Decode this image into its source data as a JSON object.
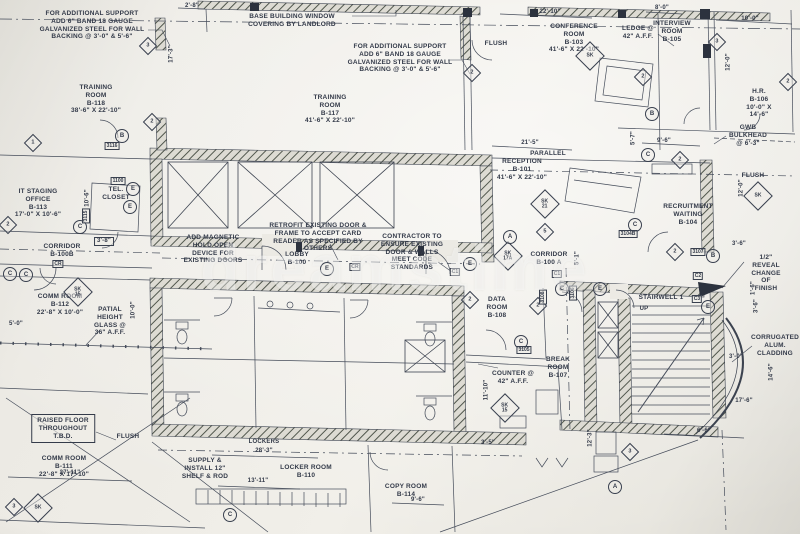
{
  "palette": {
    "paper": "#eceae4",
    "ink": "#3c4350",
    "wall_hatch": "#4f554b",
    "solid": "#2c323e"
  },
  "watermark": {
    "text": "dreamstime"
  },
  "plan": {
    "labels": [
      {
        "name": "note-additional-support-left",
        "cls": "note",
        "x": 92,
        "y": 10,
        "text": "FOR ADDITIONAL SUPPORT\nADD 6\" BAND 18 GAUGE\nGALVANIZED STEEL FOR WALL\nBACKING @ 3'-0\" & 5'-6\""
      },
      {
        "name": "note-base-building-window",
        "cls": "note",
        "x": 292,
        "y": 13,
        "text": "BASE BUILDING WINDOW\nCOVERING BY LANDLORD"
      },
      {
        "name": "note-additional-support-center",
        "cls": "note",
        "x": 400,
        "y": 43,
        "text": "FOR ADDITIONAL SUPPORT\nADD 6\" BAND 18 GAUGE\nGALVANIZED STEEL FOR WALL\nBACKING @ 3'-0\" & 5'-6\""
      },
      {
        "name": "label-flush-conference",
        "cls": "note",
        "x": 496,
        "y": 40,
        "text": "FLUSH"
      },
      {
        "name": "room-conference",
        "cls": "room",
        "x": 574,
        "y": 23,
        "text": "CONFERENCE\nROOM\nB-103\n41'-6\" X 22'-10\""
      },
      {
        "name": "note-ledge",
        "cls": "note",
        "x": 638,
        "y": 25,
        "text": "LEDGE @\n42\" A.F.F."
      },
      {
        "name": "dim-22-10",
        "cls": "dim",
        "x": 550,
        "y": 9,
        "text": "22'-10\""
      },
      {
        "name": "dim-8-0",
        "cls": "dim",
        "x": 662,
        "y": 5,
        "text": "8'-0\""
      },
      {
        "name": "room-interview",
        "cls": "room",
        "x": 672,
        "y": 20,
        "text": "INTERVIEW\nROOM\nB-105"
      },
      {
        "name": "dim-10-0-top",
        "cls": "dim",
        "x": 750,
        "y": 16,
        "text": "10'-0\""
      },
      {
        "name": "dim-12-0-right",
        "cls": "dimv",
        "x": 729,
        "y": 62,
        "text": "12'-0\""
      },
      {
        "name": "room-hr",
        "cls": "room",
        "x": 759,
        "y": 88,
        "text": "H.R.\nB-106\n10'-0\" X 14'-6\""
      },
      {
        "name": "note-gwb-bulkhead",
        "cls": "note",
        "x": 748,
        "y": 124,
        "text": "GWB\nBULKHEAD\n@ 6'-3\""
      },
      {
        "name": "dim-5-7",
        "cls": "dimv",
        "x": 634,
        "y": 138,
        "text": "5'-7\""
      },
      {
        "name": "dim-9-6-recruitment",
        "cls": "dim",
        "x": 664,
        "y": 138,
        "text": "9'-6\""
      },
      {
        "name": "room-training-center",
        "cls": "room",
        "x": 330,
        "y": 94,
        "text": "TRAINING\nROOM\nB-117\n41'-6\" X 22'-10\""
      },
      {
        "name": "room-training-left",
        "cls": "room",
        "x": 96,
        "y": 84,
        "text": "TRAINING\nROOM\nB-118\n38'-6\" X 22'-10\""
      },
      {
        "name": "dim-17-3",
        "cls": "dimv",
        "x": 172,
        "y": 54,
        "text": "17'-3\""
      },
      {
        "name": "dim-2-8",
        "cls": "dim",
        "x": 192,
        "y": 3,
        "text": "2'-8\""
      },
      {
        "name": "room-it-staging",
        "cls": "room",
        "x": 38,
        "y": 188,
        "text": "IT STAGING\nOFFICE\nB-113\n17'-0\" X 10'-6\""
      },
      {
        "name": "room-tel-closet",
        "cls": "room",
        "x": 116,
        "y": 186,
        "text": "TEL.\nCLOSET"
      },
      {
        "name": "dim-10-6",
        "cls": "dimv",
        "x": 88,
        "y": 198,
        "text": "10'-6\""
      },
      {
        "name": "dim-3-8",
        "cls": "dimbox",
        "x": 104,
        "y": 237,
        "text": "3'-8\""
      },
      {
        "name": "room-corridor-b100b",
        "cls": "room",
        "x": 62,
        "y": 243,
        "text": "CORRIDOR\nB-100B"
      },
      {
        "name": "room-comm-112",
        "cls": "room",
        "x": 60,
        "y": 293,
        "text": "COMM ROOM\nB-112\n22'-8\" X 10'-0\""
      },
      {
        "name": "note-partial-glass",
        "cls": "note",
        "x": 110,
        "y": 306,
        "text": "PATIAL\nHEIGHT\nGLASS @\n36\" A.F.F."
      },
      {
        "name": "dim-5-0",
        "cls": "dim",
        "x": 16,
        "y": 321,
        "text": "5'-0\""
      },
      {
        "name": "dim-10-0-glass",
        "cls": "dimv",
        "x": 134,
        "y": 310,
        "text": "10'-0\""
      },
      {
        "name": "note-add-magnetic",
        "cls": "note",
        "x": 213,
        "y": 234,
        "text": "ADD MAGNETIC\nHOLD OPEN\nDEVICE FOR\nEXISTING DOORS"
      },
      {
        "name": "note-retrofit",
        "cls": "note",
        "x": 318,
        "y": 222,
        "text": "RETROFIT EXISTING DOOR &\nFRAME TO ACCEPT CARD\nREADER AS SPECIFIED BY\nOTHERS"
      },
      {
        "name": "room-lobby",
        "cls": "room",
        "x": 297,
        "y": 251,
        "text": "LOBBY\nB-100"
      },
      {
        "name": "note-contractor",
        "cls": "note",
        "x": 412,
        "y": 233,
        "text": "CONTRACTOR TO\nENSURE EXISTING\nDOOR & WALLS\nMEET CODE\nSTANDARDS"
      },
      {
        "name": "room-corridor-b100a",
        "cls": "room",
        "x": 549,
        "y": 251,
        "text": "CORRIDOR\nB-100 A"
      },
      {
        "name": "dim-5-1",
        "cls": "dimv",
        "x": 578,
        "y": 258,
        "text": "5'-1\""
      },
      {
        "name": "room-reception",
        "cls": "room",
        "x": 522,
        "y": 158,
        "text": "RECEPTION\nB-101\n41'-6\" X 22'-10\""
      },
      {
        "name": "note-parallel",
        "cls": "note",
        "x": 548,
        "y": 150,
        "text": "PARALLEL"
      },
      {
        "name": "dim-21-5",
        "cls": "dim",
        "x": 530,
        "y": 140,
        "text": "21'-5\""
      },
      {
        "name": "room-recruitment",
        "cls": "room",
        "x": 688,
        "y": 203,
        "text": "RECRUITMENT\nWAITING\nB-104"
      },
      {
        "name": "label-flush-right",
        "cls": "note",
        "x": 753,
        "y": 172,
        "text": "FLUSH"
      },
      {
        "name": "dim-12-0-recruitment",
        "cls": "dimv",
        "x": 742,
        "y": 188,
        "text": "12'-0\""
      },
      {
        "name": "dim-3-6-right",
        "cls": "dim",
        "x": 739,
        "y": 241,
        "text": "3'-6\""
      },
      {
        "name": "note-reveal",
        "cls": "note",
        "x": 766,
        "y": 254,
        "text": "1/2\" REVEAL\nCHANGE OF\nFINISH"
      },
      {
        "name": "room-stairwell",
        "cls": "room",
        "x": 661,
        "y": 294,
        "text": "STAIRWELL 1"
      },
      {
        "name": "label-up",
        "cls": "small",
        "x": 644,
        "y": 306,
        "text": "UP"
      },
      {
        "name": "note-cladding",
        "cls": "note",
        "x": 775,
        "y": 334,
        "text": "CORRUGATED\nALUM.\nCLADDING"
      },
      {
        "name": "dim-1-6",
        "cls": "dimv",
        "x": 754,
        "y": 288,
        "text": "1'-6\""
      },
      {
        "name": "dim-3-6-stair",
        "cls": "dimv",
        "x": 757,
        "y": 306,
        "text": "3'-6\""
      },
      {
        "name": "dim-3-0",
        "cls": "dim",
        "x": 736,
        "y": 354,
        "text": "3'-0\""
      },
      {
        "name": "dim-14-6",
        "cls": "dimv",
        "x": 772,
        "y": 372,
        "text": "14'-6\""
      },
      {
        "name": "dim-17-6",
        "cls": "dim",
        "x": 744,
        "y": 398,
        "text": "17'-6\""
      },
      {
        "name": "room-data",
        "cls": "room",
        "x": 497,
        "y": 296,
        "text": "DATA\nROOM\nB-108"
      },
      {
        "name": "room-break",
        "cls": "room",
        "x": 558,
        "y": 356,
        "text": "BREAK\nROOM\nB-107"
      },
      {
        "name": "note-counter",
        "cls": "note",
        "x": 513,
        "y": 370,
        "text": "COUNTER @\n42\" A.F.F."
      },
      {
        "name": "dim-11-10",
        "cls": "dimv",
        "x": 487,
        "y": 390,
        "text": "11'-10\""
      },
      {
        "name": "dim-3-5",
        "cls": "dim",
        "x": 488,
        "y": 440,
        "text": "3'-5\""
      },
      {
        "name": "note-raised-floor",
        "cls": "notebox",
        "x": 63,
        "y": 414,
        "text": "RAISED FLOOR\nTHROUGHOUT\nT.B.D."
      },
      {
        "name": "room-comm-111",
        "cls": "room",
        "x": 64,
        "y": 455,
        "text": "COMM ROOM\nB-111\n22'-8\" X 17'-10\""
      },
      {
        "name": "dim-27-11",
        "cls": "dim",
        "x": 70,
        "y": 470,
        "text": "27'-11\""
      },
      {
        "name": "label-flush-bottom",
        "cls": "note",
        "x": 128,
        "y": 433,
        "text": "FLUSH"
      },
      {
        "name": "label-lockers",
        "cls": "small",
        "x": 264,
        "y": 439,
        "text": "LOCKERS"
      },
      {
        "name": "dim-28-3",
        "cls": "dim",
        "x": 264,
        "y": 448,
        "text": "28'-3\""
      },
      {
        "name": "note-shelf-rod",
        "cls": "note",
        "x": 205,
        "y": 457,
        "text": "SUPPLY &\nINSTALL 12\"\nSHELF & ROD"
      },
      {
        "name": "room-locker",
        "cls": "room",
        "x": 306,
        "y": 464,
        "text": "LOCKER ROOM\nB-110"
      },
      {
        "name": "dim-13-11",
        "cls": "dim",
        "x": 258,
        "y": 478,
        "text": "13'-11\""
      },
      {
        "name": "room-copy",
        "cls": "room",
        "x": 406,
        "y": 483,
        "text": "COPY ROOM\nB-114"
      },
      {
        "name": "dim-9-6-copy",
        "cls": "dim",
        "x": 418,
        "y": 497,
        "text": "9'-6\""
      },
      {
        "name": "dim-6-6",
        "cls": "dim",
        "x": 704,
        "y": 428,
        "text": "6'-6\""
      },
      {
        "name": "dim-12-3",
        "cls": "dimv",
        "x": 591,
        "y": 438,
        "text": "12'-3\""
      }
    ],
    "diamond_markers": [
      {
        "x": 148,
        "y": 46,
        "text": "3",
        "big": false
      },
      {
        "x": 472,
        "y": 73,
        "text": "2",
        "big": false
      },
      {
        "x": 152,
        "y": 122,
        "text": "2",
        "big": false
      },
      {
        "x": 33,
        "y": 143,
        "text": "1",
        "big": false
      },
      {
        "x": 717,
        "y": 42,
        "text": "3",
        "big": false
      },
      {
        "x": 643,
        "y": 77,
        "text": "2",
        "big": false
      },
      {
        "x": 788,
        "y": 82,
        "text": "2",
        "big": false
      },
      {
        "x": 8,
        "y": 225,
        "text": "2",
        "big": false
      },
      {
        "x": 538,
        "y": 306,
        "text": "2",
        "big": false
      },
      {
        "x": 545,
        "y": 232,
        "text": "5",
        "big": false
      },
      {
        "x": 680,
        "y": 160,
        "text": "2",
        "big": false
      },
      {
        "x": 675,
        "y": 252,
        "text": "2",
        "big": false
      },
      {
        "x": 630,
        "y": 452,
        "text": "3",
        "big": false
      },
      {
        "x": 14,
        "y": 507,
        "text": "3",
        "big": false
      },
      {
        "x": 470,
        "y": 300,
        "text": "2",
        "big": false
      },
      {
        "x": 545,
        "y": 204,
        "text": "SK\n21",
        "big": true
      },
      {
        "x": 508,
        "y": 256,
        "text": "SK\n17A",
        "big": true
      },
      {
        "x": 78,
        "y": 292,
        "text": "SK\n15",
        "big": true
      },
      {
        "x": 505,
        "y": 408,
        "text": "SK\n15",
        "big": true
      },
      {
        "x": 590,
        "y": 56,
        "text": "SK",
        "big": true
      },
      {
        "x": 758,
        "y": 196,
        "text": "SK",
        "big": true
      },
      {
        "x": 38,
        "y": 508,
        "text": "SK",
        "big": true
      }
    ],
    "circle_markers": [
      {
        "x": 122,
        "y": 136,
        "text": "B"
      },
      {
        "x": 80,
        "y": 227,
        "text": "C"
      },
      {
        "x": 133,
        "y": 189,
        "text": "E"
      },
      {
        "x": 130,
        "y": 207,
        "text": "E"
      },
      {
        "x": 327,
        "y": 269,
        "text": "E"
      },
      {
        "x": 470,
        "y": 264,
        "text": "E"
      },
      {
        "x": 510,
        "y": 237,
        "text": "A"
      },
      {
        "x": 562,
        "y": 289,
        "text": "C"
      },
      {
        "x": 600,
        "y": 289,
        "text": "E"
      },
      {
        "x": 521,
        "y": 342,
        "text": "C"
      },
      {
        "x": 652,
        "y": 114,
        "text": "B"
      },
      {
        "x": 648,
        "y": 155,
        "text": "C"
      },
      {
        "x": 635,
        "y": 225,
        "text": "C"
      },
      {
        "x": 713,
        "y": 256,
        "text": "B"
      },
      {
        "x": 708,
        "y": 307,
        "text": "E"
      },
      {
        "x": 615,
        "y": 487,
        "text": "A"
      },
      {
        "x": 10,
        "y": 274,
        "text": "C"
      },
      {
        "x": 26,
        "y": 275,
        "text": "C"
      },
      {
        "x": 230,
        "y": 515,
        "text": "C"
      }
    ],
    "wall_tags": [
      {
        "x": 112,
        "y": 146,
        "text": "3116",
        "vert": false
      },
      {
        "x": 118,
        "y": 181,
        "text": "1100",
        "vert": false
      },
      {
        "x": 86,
        "y": 216,
        "text": "3115",
        "vert": true
      },
      {
        "x": 58,
        "y": 264,
        "text": "CR",
        "vert": false
      },
      {
        "x": 557,
        "y": 274,
        "text": "C1",
        "vert": false
      },
      {
        "x": 698,
        "y": 276,
        "text": "C2",
        "vert": false
      },
      {
        "x": 697,
        "y": 299,
        "text": "C3",
        "vert": false
      },
      {
        "x": 628,
        "y": 234,
        "text": "3104B",
        "vert": false
      },
      {
        "x": 698,
        "y": 252,
        "text": "3107",
        "vert": false
      },
      {
        "x": 524,
        "y": 350,
        "text": "3105",
        "vert": false
      },
      {
        "x": 573,
        "y": 293,
        "text": "3106",
        "vert": true
      },
      {
        "x": 455,
        "y": 272,
        "text": "C1",
        "vert": false
      },
      {
        "x": 543,
        "y": 297,
        "text": "3108",
        "vert": true
      },
      {
        "x": 355,
        "y": 267,
        "text": "CR",
        "vert": false
      }
    ]
  }
}
